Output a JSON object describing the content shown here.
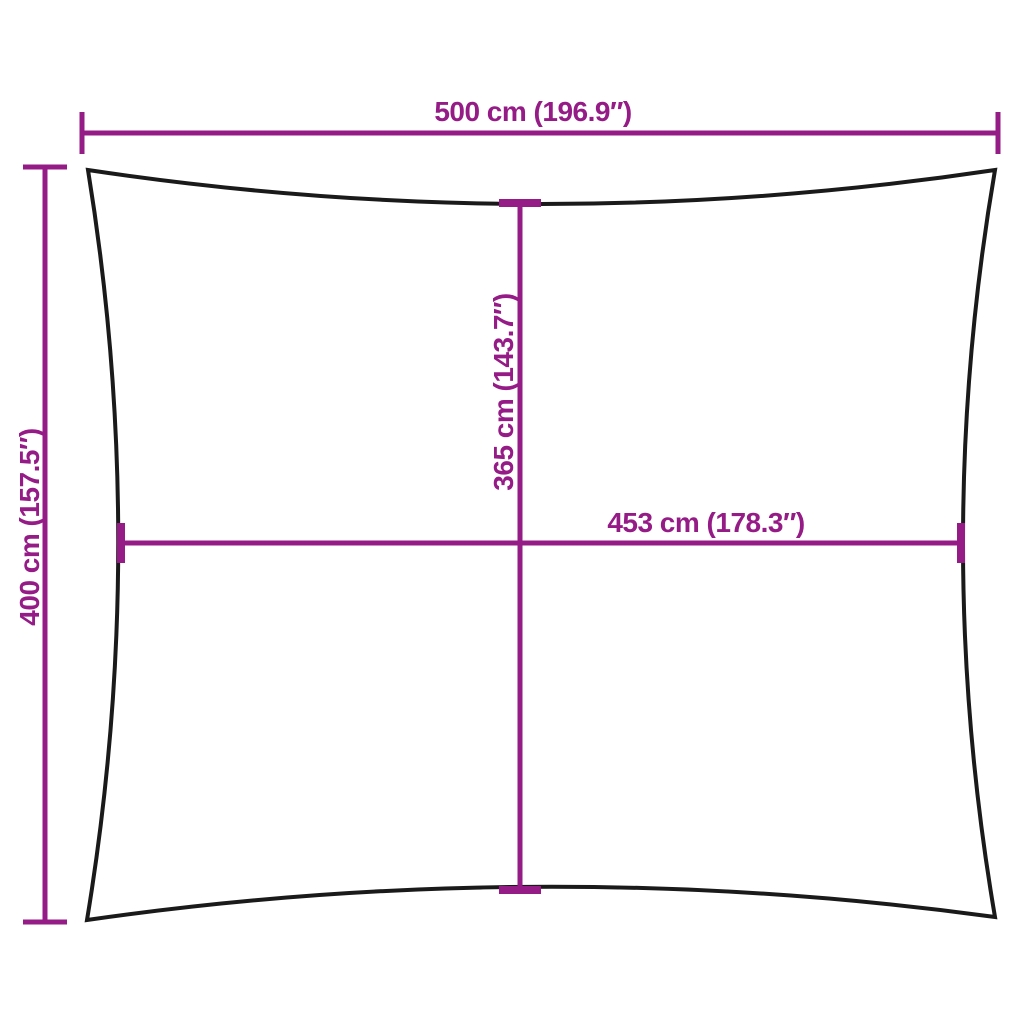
{
  "diagram": {
    "type": "product-dimension-diagram",
    "colors": {
      "dimension": "#951b86",
      "outline": "#1a1a1a",
      "background": "#ffffff"
    },
    "dimensions": {
      "top_width": {
        "label": "500 cm (196.9″)",
        "cm": 500,
        "inches": 196.9
      },
      "left_height": {
        "label": "400 cm (157.5″)",
        "cm": 400,
        "inches": 157.5
      },
      "center_height": {
        "label": "365 cm (143.7″)",
        "cm": 365,
        "inches": 143.7
      },
      "center_width": {
        "label": "453 cm (178.3″)",
        "cm": 453,
        "inches": 178.3
      }
    }
  }
}
